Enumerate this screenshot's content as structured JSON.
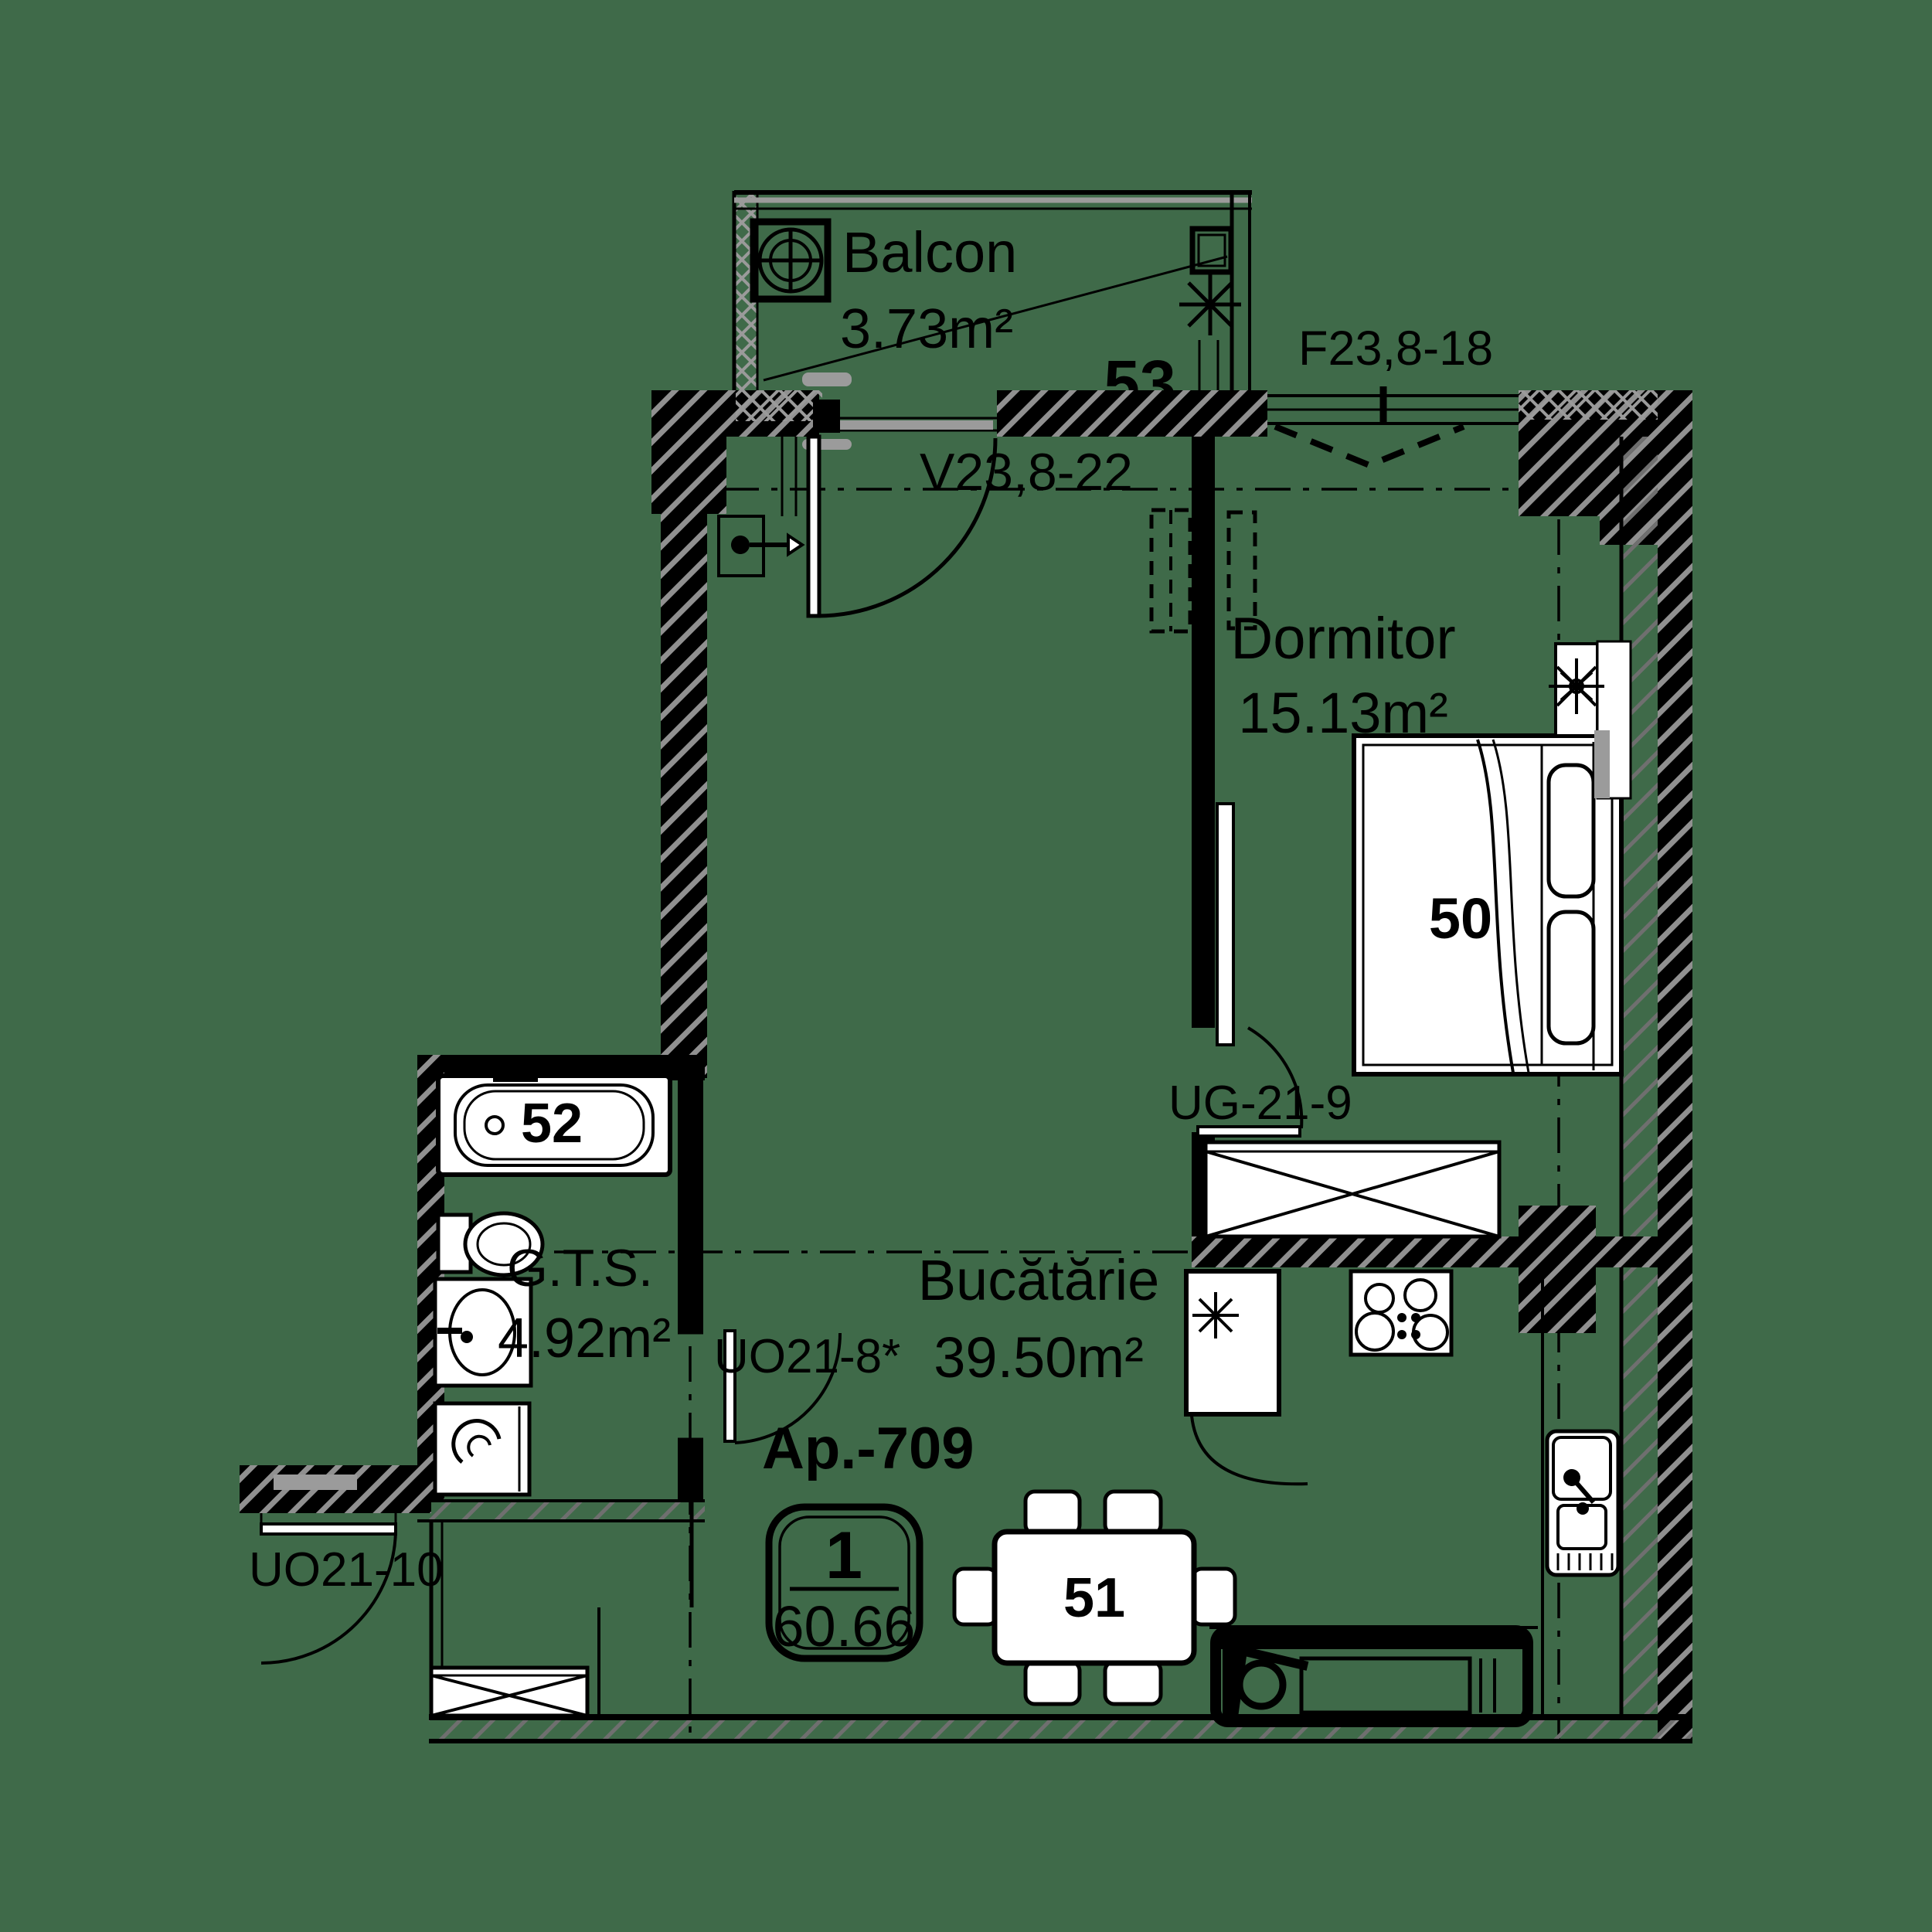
{
  "apartment": {
    "label": "Ap.-709",
    "rooms_count": "1",
    "total_area": "60.66"
  },
  "rooms": {
    "balcon": {
      "name": "Balcon",
      "area": "3.73m²",
      "number": "53"
    },
    "dormitor": {
      "name": "Dormitor",
      "area": "15.13m²",
      "number": "50"
    },
    "gts": {
      "name": "G.T.S.",
      "area": "4.92m²",
      "number": "52"
    },
    "bucatarie": {
      "name": "Bucătărie",
      "area": "39.50m²",
      "number": "51"
    }
  },
  "openings": {
    "window_bedroom": "F23,8-18",
    "door_balcony": "V23,8-22",
    "door_bedroom": "UG-21-9",
    "door_bathroom": "UO21-8*",
    "door_entry": "UO21-10"
  },
  "colors": {
    "background": "#3F6A49",
    "line": "#000000",
    "hatch_on_wall": "#909090",
    "hatch_light": "#6F6F6F",
    "accent_gray": "#9B9B9B",
    "fixture_fill": "#FFFFFF"
  }
}
